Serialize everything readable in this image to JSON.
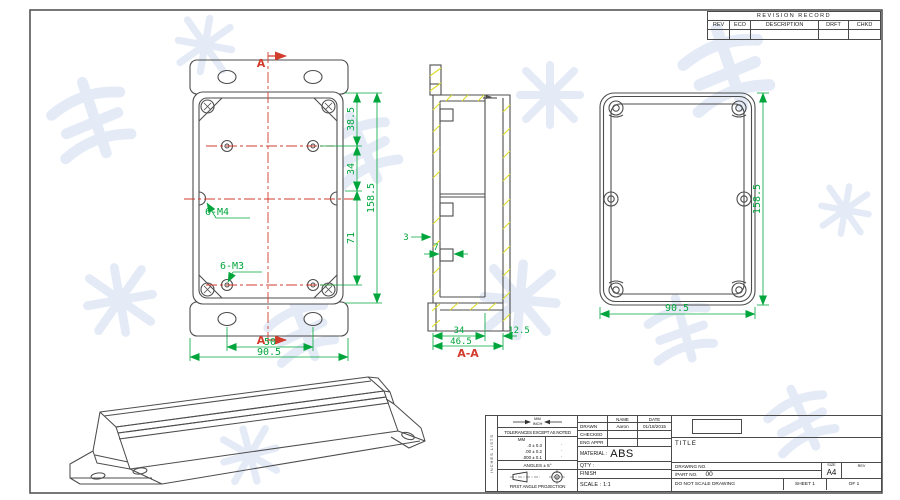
{
  "revision_table": {
    "title": "REVISION RECORD",
    "columns": [
      "REV",
      "ECO",
      "DESCRIPTION",
      "DRFT",
      "CHKD"
    ]
  },
  "front_view": {
    "section_arrow_top": "A",
    "section_arrow_bottom": "A",
    "label_m4": "6-M4",
    "label_m3": "6-M3",
    "dim_385": "38.5",
    "dim_34": "34",
    "dim_71": "71",
    "dim_1585": "158.5",
    "dim_50": "50",
    "dim_905": "90.5"
  },
  "section_view": {
    "label": "A-A",
    "dim_3": "3",
    "dim_7": "7",
    "dim_34": "34",
    "dim_465": "46.5",
    "dim_125": "12.5"
  },
  "back_view": {
    "dim_height": "158.5",
    "dim_width": "90.5"
  },
  "title_block": {
    "side_note": "INCHES LISTS",
    "units_mm": "MM",
    "units_inch": "INCH",
    "tolerances_heading": "TOLERANCES EXCEPT AS NOTED",
    "tol_col_header": "MM",
    "tol_rows": [
      ".0 ± 0.3",
      ".00 ± 0.2",
      ".000 ± 0.1"
    ],
    "tol_dots": [
      "·",
      "·",
      "·"
    ],
    "angles": "ANGLES ± 5°",
    "projection": "FIRST ANGLE PROJECTION",
    "name_header": "NAME",
    "date_header": "DATE",
    "drawn_label": "DRAWN",
    "drawn_name": "Aaron",
    "drawn_date": "01/18/2015",
    "checked_label": "CHECKED",
    "eng_appr_label": "ENG APPR",
    "material_label": "MATERIAL :",
    "material_value": "ABS",
    "qty_label": "QT'Y :",
    "finish_label": "FINISH",
    "scale_label": "SCALE :",
    "scale_value": "1:1",
    "title_label": "TITLE",
    "drawing_no_label": "DRAWING NO.",
    "part_no_label": "/PART NO.",
    "part_no_value": "00",
    "size_label": "SIZE",
    "size_value": "A4",
    "rev_label": "REV",
    "do_not_scale": "DO NOT SCALE DRAWING",
    "sheet_label": "SHEET 1",
    "of_label": "OF 1"
  },
  "colors": {
    "outline": "#4d4d4d",
    "dimension_green": "#00A63C",
    "centerline_red": "#D23C2D",
    "hatch_yellow": "#DCDC28",
    "watermark_blue": "#E4EBF7"
  }
}
